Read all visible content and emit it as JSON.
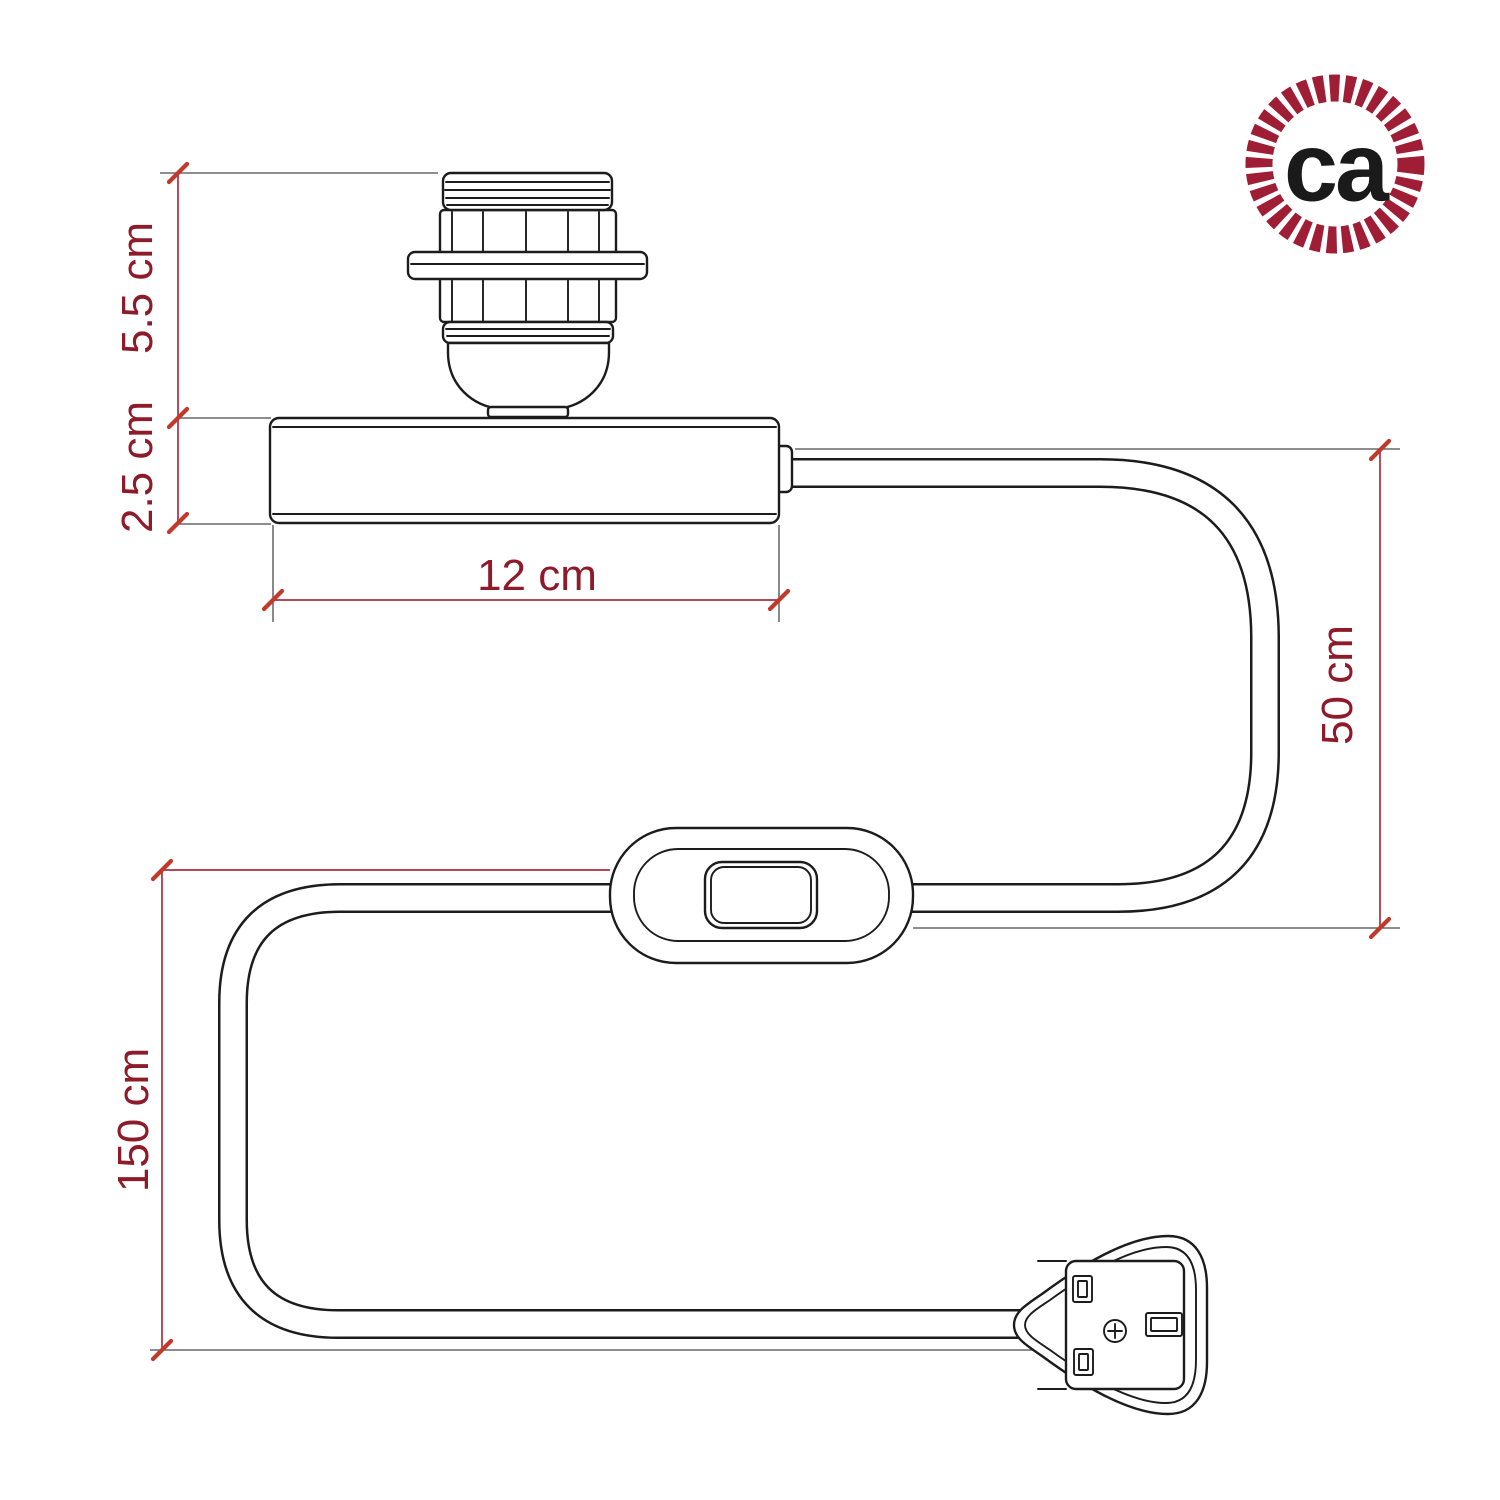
{
  "dimensions": {
    "socket_height": "5.5 cm",
    "base_height": "2.5 cm",
    "base_width": "12 cm",
    "upper_cable_length": "50 cm",
    "lower_cable_length": "150 cm"
  },
  "logo": {
    "text": "ca"
  },
  "colors": {
    "line_art": "#1c1c1c",
    "dimension_line": "#a83040",
    "dimension_text": "#8e1b2a",
    "tick": "#c0392b",
    "extension_line": "#4a4a4a",
    "logo_ring": "#a01e35",
    "logo_text": "#1a1a1a",
    "background": "#ffffff"
  }
}
